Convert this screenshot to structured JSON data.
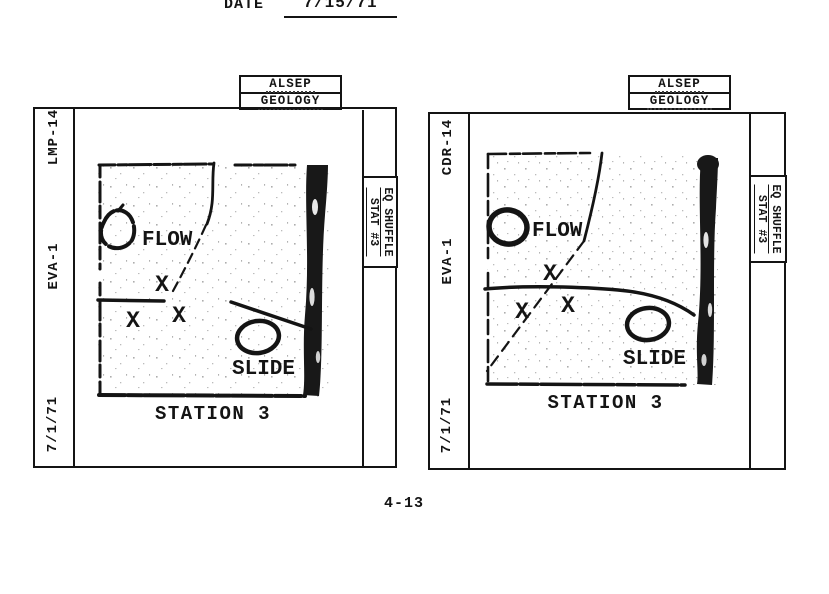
{
  "header": {
    "date_label": "DATE",
    "date_value": "7/15/71"
  },
  "footer": {
    "page_number": "4-13"
  },
  "colors": {
    "ink": "#141414",
    "paper": "#ffffff"
  },
  "panels": [
    {
      "top_tab": {
        "line1": "ALSEP",
        "line2": "GEOLOGY"
      },
      "side": {
        "crew": "LMP-14",
        "eva": "EVA-1",
        "date": "7/1/71"
      },
      "side_tab": {
        "line1": "EQ SHUFFLE",
        "line2": "STAT #3"
      },
      "map": {
        "flow": "FLOW",
        "slide": "SLIDE",
        "x1": "X",
        "x2": "X",
        "x3": "X",
        "caption": "STATION 3"
      }
    },
    {
      "top_tab": {
        "line1": "ALSEP",
        "line2": "GEOLOGY"
      },
      "side": {
        "crew": "CDR-14",
        "eva": "EVA-1",
        "date": "7/1/71"
      },
      "side_tab": {
        "line1": "EQ SHUFFLE",
        "line2": "STAT #3"
      },
      "map": {
        "flow": "FLOW",
        "slide": "SLIDE",
        "x1": "X",
        "x2": "X",
        "x3": "X",
        "caption": "STATION 3"
      }
    }
  ]
}
